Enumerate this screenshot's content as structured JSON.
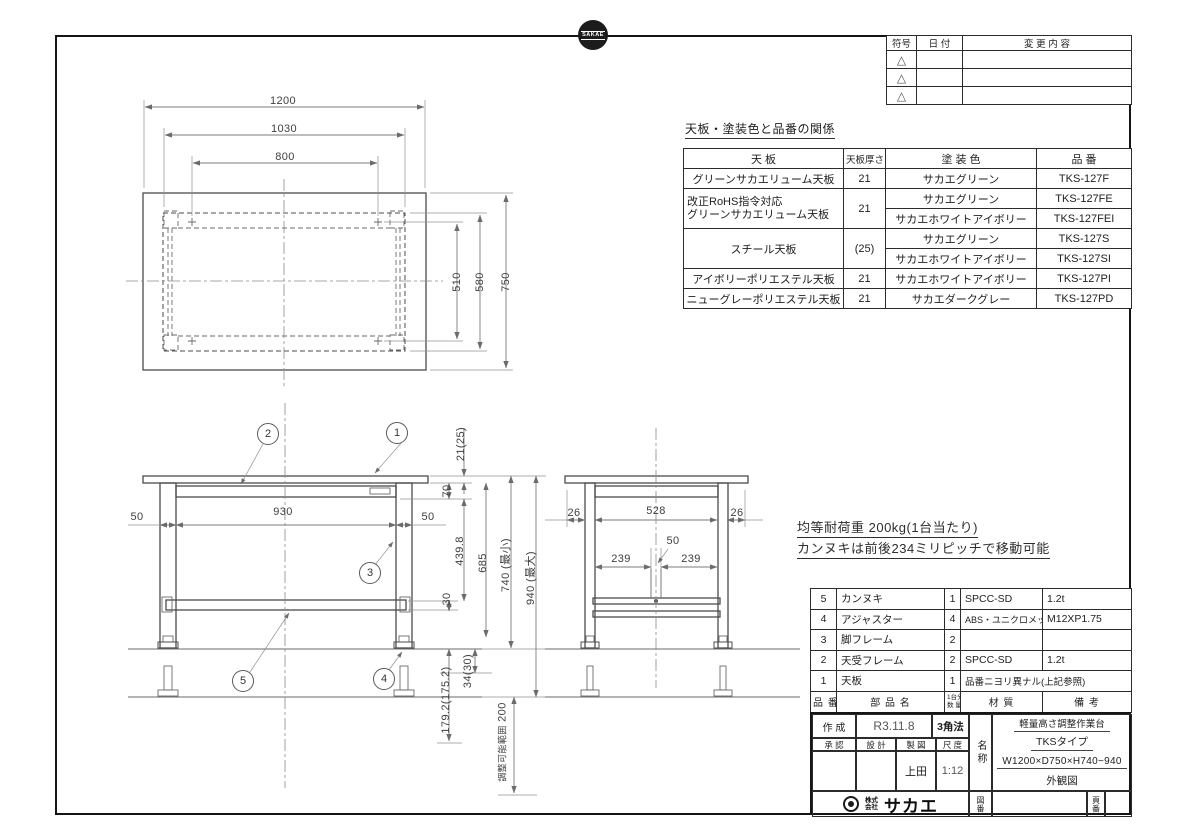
{
  "drawing": {
    "logo_text": "SAKAE",
    "company_prefix": "株式会社",
    "company_name": "サカエ"
  },
  "revision_table": {
    "col_mark": "符号",
    "col_date": "日  付",
    "col_change": "変 更 内 容",
    "mark": "△"
  },
  "finish_table": {
    "title": "天板・塗装色と品番の関係",
    "h_tenban": "天  板",
    "h_thickness": "天板厚さ",
    "h_color": "塗 装 色",
    "h_part": "品  番",
    "rows": [
      {
        "tenban": "グリーンサカエリューム天板",
        "thickness": "21",
        "color": "サカエグリーン",
        "part": "TKS-127F"
      },
      {
        "tenban_l1": "改正RoHS指令対応",
        "tenban_l2": "グリーンサカエリューム天板",
        "thickness": "21",
        "color1": "サカエグリーン",
        "part1": "TKS-127FE",
        "color2": "サカエホワイトアイボリー",
        "part2": "TKS-127FEI"
      },
      {
        "tenban": "スチール天板",
        "thickness": "(25)",
        "color1": "サカエグリーン",
        "part1": "TKS-127S",
        "color2": "サカエホワイトアイボリー",
        "part2": "TKS-127SI"
      },
      {
        "tenban": "アイボリーポリエステル天板",
        "thickness": "21",
        "color": "サカエホワイトアイボリー",
        "part": "TKS-127PI"
      },
      {
        "tenban": "ニューグレーポリエステル天板",
        "thickness": "21",
        "color": "サカエダークグレー",
        "part": "TKS-127PD"
      }
    ]
  },
  "notes": {
    "line1": "均等耐荷重  200kg(1台当たり)",
    "line2": "カンヌキは前後234ミリピッチで移動可能"
  },
  "plan_dims": {
    "w_outer": "1200",
    "w_frame": "1030",
    "w_holes": "800",
    "d_holes": "510",
    "d_frame": "580",
    "d_outer": "750"
  },
  "front_dims": {
    "left_50": "50",
    "center_930": "930",
    "right_50": "50",
    "top_21": "21(25)",
    "f70": "70",
    "f439": "439.8",
    "f685": "685",
    "f30": "30",
    "h_min": "740 (最小)",
    "h_max": "940 (最大)",
    "adj_34": "34(30)",
    "adj_179": "179.2(175.2)",
    "adj_range_label": "調整可能範囲",
    "adj_200": "200"
  },
  "side_dims": {
    "left_26": "26",
    "center_528": "528",
    "right_26": "26",
    "mid_50": "50",
    "off_l": "239",
    "off_r": "239"
  },
  "balloons": [
    "1",
    "2",
    "3",
    "4",
    "5"
  ],
  "parts_table": {
    "h_no": "品 番",
    "h_name": "部 品 名",
    "h_qty_l1": "1台分",
    "h_qty_l2": "数 量",
    "h_material": "材  質",
    "h_remark": "備  考",
    "rows": [
      {
        "no": "5",
        "name": "カンヌキ",
        "qty": "1",
        "material": "SPCC-SD",
        "remark": "1.2t"
      },
      {
        "no": "4",
        "name": "アジャスター",
        "qty": "4",
        "material": "ABS・ユニクロメッキ",
        "remark": "M12XP1.75"
      },
      {
        "no": "3",
        "name": "脚フレーム",
        "qty": "2",
        "material": "",
        "remark": ""
      },
      {
        "no": "2",
        "name": "天受フレーム",
        "qty": "2",
        "material": "SPCC-SD",
        "remark": "1.2t"
      },
      {
        "no": "1",
        "name": "天板",
        "qty": "1",
        "material": "品番ニヨリ異ナル(上記参照)",
        "remark": ""
      }
    ]
  },
  "title_block": {
    "created_label": "作 成",
    "created_value": "R3.11.8",
    "projection": "3角法",
    "h_approval": "承 認",
    "h_design": "設 計",
    "h_draft": "製 図",
    "h_scale": "尺 度",
    "drafter": "上田",
    "scale": "1:12",
    "name_label": "名称",
    "product_line1": "軽量高さ調整作業台",
    "product_line2": "TKSタイプ",
    "product_line3": "W1200×D750×H740~940",
    "product_line4": "外観図",
    "zuban_label": "図番",
    "yoban_label": "頁番"
  }
}
